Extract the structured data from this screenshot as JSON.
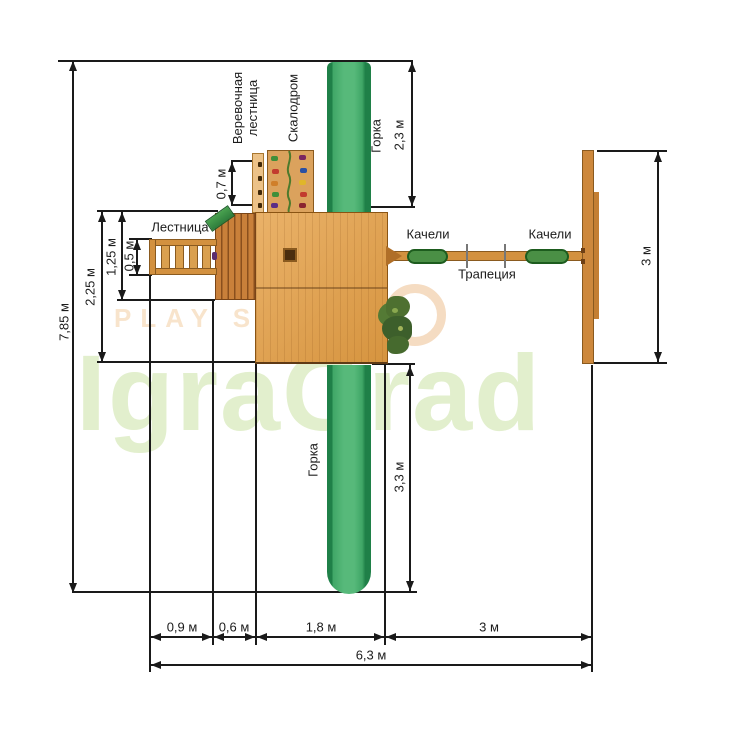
{
  "diagram": {
    "title": "Playground top-view plan",
    "type": "dimension-drawing"
  },
  "watermark": {
    "brand": "IgraGrad",
    "sub": "PLAY SYS"
  },
  "labels": {
    "rope_ladder": "Веревочная\nлестница",
    "climbing_wall": "Скалодром",
    "slide_top": "Горка",
    "slide_bottom": "Горка",
    "ladder": "Лестница",
    "swing_left": "Качели",
    "swing_right": "Качели",
    "trapeze": "Трапеция"
  },
  "dimensions": {
    "total_height": "7,85 м",
    "left_depth": "2,25 м",
    "left_inner": "1,25 м",
    "ladder_width": "0,5 м",
    "rope_ladder_width": "0,7 м",
    "slide_top_length": "2,3 м",
    "right_frame_length": "3 м",
    "slide_bottom_length": "3,3 м",
    "bottom_segments": [
      "0,9 м",
      "0,6 м",
      "1,8 м",
      "3 м"
    ],
    "total_width": "6,3 м"
  },
  "colors": {
    "slide_green": "#3fa666",
    "wood": "#d6943f",
    "fence_wood": "#c9803a",
    "seat_green": "#4a8f45",
    "line": "#1a1a1a",
    "watermark_green": "#e2efcd",
    "watermark_peach": "#f8e4cc"
  }
}
